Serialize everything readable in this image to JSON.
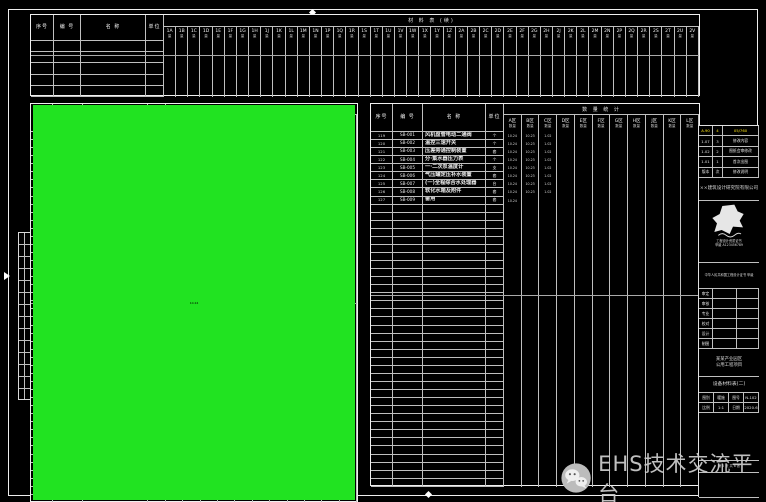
{
  "colors": {
    "green": "#21e321",
    "yellow": "#ffe712",
    "cyan": "#25e6f0",
    "white": "#eaeaea",
    "line": "#bfbfbf"
  },
  "watermark": {
    "text": "EHS技术交流平台",
    "icon": "wechat-icon"
  },
  "schedules": {
    "top": {
      "title": "材 料 表 (续)",
      "fixed": [
        "序号",
        "编 号",
        "名  称",
        "单位"
      ],
      "col_sub": "量",
      "cols": [
        "1A",
        "1B",
        "1C",
        "1D",
        "1E",
        "1F",
        "1G",
        "1H",
        "1J",
        "1K",
        "1L",
        "1M",
        "1N",
        "1P",
        "1Q",
        "1R",
        "1S",
        "1T",
        "1U",
        "1V",
        "1W",
        "1X",
        "1Y",
        "1Z",
        "2A",
        "2B",
        "2C",
        "2D",
        "2E",
        "2F",
        "2G",
        "2H",
        "2J",
        "2K",
        "2L",
        "2M",
        "2N",
        "2P",
        "2Q",
        "2R",
        "2S",
        "2T",
        "2U",
        "2V"
      ],
      "empty_rows": 5
    },
    "left": {
      "title": "数 量 统 计",
      "fixed": [
        "序号",
        "编 号",
        "名  称",
        "单位"
      ],
      "col_sub": "数量",
      "cols": [
        "A区",
        "B区",
        "C区",
        "D区",
        "E区",
        "F区",
        "G区",
        "H区",
        "J区",
        "K区",
        "L区"
      ],
      "rows": [
        {
          "n": "73",
          "id": "ZB-404",
          "nm": "离心式冷水机组",
          "sp": "台",
          "c": "g",
          "cc": "w",
          "v": [
            "10.24",
            "5.02"
          ],
          "hl": 2
        },
        {
          "n": "74",
          "id": "ZB-405",
          "nm": "卧式端吸离心泵",
          "sp": "台",
          "c": "g",
          "cc": "w",
          "v": [
            "10.24",
            "5.02"
          ],
          "hl": 2
        },
        {
          "n": "75",
          "id": "ZB-406",
          "nm": "板式换热器",
          "sp": "台",
          "c": "g",
          "cc": "w",
          "v": [
            "10.24",
            "5.02"
          ],
          "hl": 2
        },
        {
          "n": "76",
          "id": "ZB-407",
          "nm": "全自动软水装置",
          "sp": "套",
          "c": "g",
          "cc": "w",
          "v": [
            "10.24",
            "5.02",
            "1.02",
            "1.02"
          ],
          "hl": 4
        },
        {
          "n": "77",
          "id": "ZB-408",
          "nm": "(一) 落地式膨胀水箱",
          "sp": "套",
          "c": "w",
          "v": [
            "10.24",
            "5.02"
          ],
          "hl": -1
        },
        {
          "n": "78",
          "id": "ZB-409",
          "nm": "集水器·分水器",
          "sp": "套",
          "c": "g",
          "cc": "w",
          "v": [
            "10.24",
            "5.02"
          ],
          "hl": 2
        },
        {
          "n": "79",
          "id": "ZB-410",
          "nm": "定压补水排气装置",
          "sp": "套",
          "c": "g",
          "cc": "w",
          "v": [
            "10.24",
            "5.02"
          ],
          "hl": 2
        },
        {
          "n": "80",
          "id": "ZB-411",
          "nm": "电子水处理仪",
          "sp": "台",
          "c": "g",
          "v": [
            "10.24",
            "5.02"
          ],
          "hl": 2
        },
        {
          "n": "81",
          "id": "ZB-412",
          "nm": "闭式冷却塔",
          "sp": "台",
          "c": "g",
          "v": [
            "10.24",
            "5.02"
          ],
          "hl": 2
        },
        {
          "n": "82",
          "id": "ZB-413",
          "nm": "吊顶式新风换气机",
          "sp": "台",
          "c": "y",
          "v": [
            "10.24"
          ],
          "hl": 2
        },
        {
          "n": "83",
          "id": "ZB-414",
          "nm": "组合风柜",
          "sp": "台",
          "c": "w",
          "v": [
            "10.24"
          ],
          "hl": -1
        },
        {
          "n": "84",
          "id": "ZB-415",
          "nm": "柜式离心风机箱",
          "sp": "台",
          "c": "w",
          "v": [
            "10.24"
          ],
          "hl": -1
        },
        {
          "n": "85",
          "id": "ZB-416",
          "nm": "Φ-25不锈钢波纹管",
          "sp": "米",
          "c": "c",
          "v": [
            "10.24",
            "5.02",
            "1.02"
          ],
          "hl": 4
        },
        {
          "n": "86",
          "id": "ZB-417",
          "nm": "Y型过滤器",
          "sp": "个",
          "c": "w",
          "v": [
            "10.24"
          ],
          "hl": -1
        },
        {
          "n": "87",
          "id": "ZB-418",
          "nm": "(配对)法兰",
          "sp": "副",
          "c": "w",
          "v": [
            "10.24"
          ],
          "hl": -1
        },
        {
          "n": "88",
          "id": "ZB-419",
          "nm": "橡胶软接头",
          "sp": "个",
          "c": "w",
          "v": [
            "10.24"
          ],
          "hl": -1
        },
        {
          "n": "89",
          "id": "ZB-420",
          "nm": "(一) 多叶送风口",
          "sp": "个",
          "c": "y",
          "v": [
            "10.24"
          ],
          "hl": 2
        },
        {
          "n": "90",
          "id": "ZB-421",
          "nm": "(一)电动调节阀",
          "sp": "个",
          "c": "y",
          "v": [
            "10.24"
          ],
          "hl": 2
        },
        {
          "n": "91",
          "id": "ZB-422",
          "nm": "(一) 静态平衡阀",
          "sp": "个",
          "c": "c",
          "v": [
            "10.24"
          ],
          "hl": 2
        },
        {
          "n": "92",
          "id": "ZB-423",
          "nm": "(一)动态压差平衡阀",
          "sp": "个",
          "c": "c",
          "v": [
            "10.24"
          ],
          "hl": 2
        },
        {
          "n": "93",
          "id": "ZB-424",
          "nm": "(一) 自动排气阀",
          "sp": "个",
          "c": "g",
          "cc": "y",
          "v": [
            "10.24"
          ],
          "hl": 2
        },
        {
          "n": "94",
          "id": "ZB-425",
          "nm": "金属软管",
          "sp": "根",
          "c": "c",
          "v": [
            "10.24"
          ],
          "hl": 2
        },
        {
          "n": "95",
          "id": "ZB-426",
          "nm": "铝合金百叶回风口",
          "sp": "个",
          "c": "c",
          "v": [
            "10.24"
          ],
          "hl": 2
        },
        {
          "n": "96",
          "id": "ZB-427",
          "nm": "方形散流器",
          "sp": "个",
          "c": "c",
          "v": [
            "10.24"
          ],
          "hl": 2
        },
        {
          "n": "97",
          "id": "ZB-428",
          "nm": "球形旋流风口",
          "sp": "个",
          "c": "g",
          "v": [
            "10.24"
          ],
          "hl": 2
        },
        {
          "n": "98",
          "id": "ZB-429",
          "nm": "单层百叶风口",
          "sp": "个",
          "c": "g",
          "v": [
            "10.24"
          ],
          "hl": 2
        },
        {
          "n": "99",
          "id": "ZB-430",
          "nm": "双层百叶风口",
          "sp": "个",
          "c": "g",
          "v": [
            "10.24"
          ],
          "hl": 2
        },
        {
          "n": "100",
          "id": "ZB-431",
          "nm": "防雨百叶风口",
          "sp": "个",
          "c": "g",
          "v": [
            "10.24"
          ],
          "hl": 2
        },
        {
          "n": "101",
          "id": "ZB-432",
          "nm": "自垂式百叶风口",
          "sp": "个",
          "c": "y",
          "v": [
            "10.24"
          ],
          "hl": 2
        },
        {
          "n": "102",
          "id": "ZB-433",
          "nm": "白色PE",
          "sp": "米",
          "c": "c",
          "v": [
            "10.24"
          ],
          "hl": 2
        },
        {
          "n": "103",
          "id": "ZB-434",
          "nm": "·70℃防火阀",
          "sp": "个",
          "c": "g",
          "v": [
            "10.24"
          ],
          "hl": 2
        },
        {
          "n": "104",
          "id": "ZB-435",
          "nm": "·70℃自动防火阀",
          "sp": "个",
          "c": "g",
          "v": [
            "10.24"
          ],
          "hl": 2
        },
        {
          "n": "105",
          "id": "ZB-436",
          "nm": "·280℃排烟防火阀",
          "sp": "个",
          "c": "g",
          "v": [
            "10.24"
          ],
          "hl": 2
        },
        {
          "n": "106",
          "id": "ZB-437",
          "nm": "·电动排烟阀",
          "sp": "个",
          "c": "g",
          "v": [
            "10.24"
          ],
          "hl": 2
        },
        {
          "n": "107",
          "id": "ZB-438",
          "nm": "·280℃排烟口",
          "sp": "个",
          "c": "g",
          "v": [
            "10.24"
          ],
          "hl": 2
        },
        {
          "n": "108",
          "id": "ZB-439",
          "nm": "70℃板式防火调节阀",
          "sp": "个",
          "c": "g",
          "v": [
            "10.24"
          ],
          "hl": 2
        },
        {
          "n": "109",
          "id": "ZB-440",
          "nm": "(一) 消声静压箱",
          "sp": "个",
          "c": "c",
          "v": [
            "10.24"
          ],
          "hl": 2
        },
        {
          "n": "110",
          "id": "ZB-441",
          "nm": "·消声器",
          "sp": "个",
          "c": "g",
          "v": [
            "10.24"
          ],
          "hl": 2
        },
        {
          "n": "111",
          "id": "ZB-442",
          "nm": "(一)帆布软接",
          "sp": "米",
          "c": "g",
          "v": [
            "10.24"
          ],
          "hl": 2
        },
        {
          "n": "112",
          "id": "ZB-443",
          "nm": "镀锌钢板风管",
          "sp": "㎡",
          "c": "g",
          "v": [
            "10.24"
          ],
          "hl": 2
        },
        {
          "n": "113",
          "id": "ZB-444",
          "nm": "(铝箔)玻璃棉保温板",
          "sp": "㎡",
          "c": "g",
          "v": [
            "10.24"
          ],
          "hl": 2
        },
        {
          "n": "114",
          "id": "LB-445",
          "nm": "Φ108×4无缝钢管(-)",
          "sp": "米",
          "c": "w",
          "v": [
            "10.24",
            "1.02",
            "1.02"
          ],
          "hl": -1
        },
        {
          "n": "115",
          "id": "LB-446",
          "nm": "Φ89×4无缝钢管(-)",
          "sp": "米",
          "c": "w",
          "v": [
            "10.24",
            "1.02",
            "1.02"
          ],
          "hl": -1
        },
        {
          "n": "116",
          "id": "LB-447",
          "nm": "·Φ76×4焊接钢管",
          "sp": "米",
          "c": "w",
          "v": [
            "10.24",
            "1.02",
            "1.02"
          ],
          "hl": -1
        },
        {
          "n": "117",
          "id": "LB-448",
          "nm": "·Φ57×3.5焊接钢管",
          "sp": "米",
          "c": "w",
          "v": [
            "10.24",
            "1.02",
            "1.02"
          ],
          "hl": -1
        },
        {
          "n": "118",
          "id": "LB-449",
          "nm": "Φ48×3.5焊接钢管",
          "sp": "米",
          "c": "w",
          "v": [
            "10.24",
            "1.02",
            "1.02"
          ],
          "hl": -1
        }
      ],
      "empty_rows": 0
    },
    "right": {
      "title": "数 量 统 计",
      "fixed": [
        "序号",
        "编 号",
        "名  称",
        "单位"
      ],
      "col_sub": "数量",
      "cols": [
        "A区",
        "B区",
        "C区",
        "D区",
        "E区",
        "F区",
        "G区",
        "H区",
        "J区",
        "K区",
        "L区"
      ],
      "rows": [
        {
          "n": "119",
          "id": "SB-001",
          "nm": "风机盘管电动二通阀",
          "sp": "个",
          "c": "w",
          "v": [
            "10.24",
            "10.23",
            "1.02"
          ],
          "hl": -1
        },
        {
          "n": "120",
          "id": "SB-002",
          "nm": "温控三速开关",
          "sp": "个",
          "c": "w",
          "v": [
            "10.24",
            "10.23",
            "1.02"
          ],
          "hl": -1
        },
        {
          "n": "121",
          "id": "SB-003",
          "nm": "压差旁通控制装置",
          "sp": "套",
          "c": "w",
          "v": [
            "10.24",
            "10.23",
            "1.02"
          ],
          "hl": -1
        },
        {
          "n": "122",
          "id": "SB-004",
          "nm": "分·集水器压力表",
          "sp": "个",
          "c": "w",
          "v": [
            "10.24",
            "10.23",
            "1.02"
          ],
          "hl": -1
        },
        {
          "n": "123",
          "id": "SB-005",
          "nm": "一·二次泵温度计",
          "sp": "支",
          "c": "w",
          "v": [
            "10.24",
            "10.23",
            "1.02"
          ],
          "hl": -1
        },
        {
          "n": "124",
          "id": "SB-006",
          "nm": "气压罐定压补水装置",
          "sp": "套",
          "c": "w",
          "v": [
            "10.24",
            "10.23",
            "1.02"
          ],
          "hl": -1
        },
        {
          "n": "125",
          "id": "SB-007",
          "nm": "(一)全程综合水处理器",
          "sp": "台",
          "c": "w",
          "v": [
            "10.24",
            "10.23",
            "1.02"
          ],
          "hl": -1
        },
        {
          "n": "126",
          "id": "SB-008",
          "nm": "软化水箱及附件",
          "sp": "套",
          "c": "w",
          "v": [
            "10.24",
            "10.23",
            "1.02"
          ],
          "hl": -1
        },
        {
          "n": "127",
          "id": "SB-009",
          "nm": "备用",
          "sp": "套",
          "c": "w",
          "v": [
            "10.24"
          ],
          "hl": -1
        }
      ],
      "empty_rows": 35
    }
  },
  "titleblock": {
    "revisions": [
      {
        "a": "A.90",
        "b": "4",
        "c": "05/760",
        "hl": true
      },
      {
        "a": "1.07",
        "b": "3",
        "c": "修改内容",
        "hl": false
      },
      {
        "a": "1.02",
        "b": "2",
        "c": "图纸会审修改",
        "hl": false
      },
      {
        "a": "1.01",
        "b": "1",
        "c": "首次出图",
        "hl": false
      },
      {
        "a": "版本",
        "b": "次",
        "c": "修改说明",
        "hl": false
      }
    ],
    "company": "××建筑设计研究院有限公司",
    "stamp_lines": [
      "工程设计资质证书",
      "甲级 A123456789"
    ],
    "cert": "中华人民共和国工程设计证书 甲级",
    "signatures": [
      {
        "label": "审定",
        "value": ""
      },
      {
        "label": "审核",
        "value": ""
      },
      {
        "label": "专业",
        "value": ""
      },
      {
        "label": "校对",
        "value": ""
      },
      {
        "label": "设计",
        "value": ""
      },
      {
        "label": "制图",
        "value": ""
      }
    ],
    "project": [
      "某某产业园区",
      "公用工程项目"
    ],
    "drawing_title": "设备材料表(二)",
    "meta": [
      [
        {
          "k": "图别",
          "v": "暖施"
        },
        {
          "k": "图号",
          "v": "N-102"
        }
      ],
      [
        {
          "k": "比例",
          "v": "1:1"
        },
        {
          "k": "日期",
          "v": "2020.6"
        }
      ]
    ],
    "sheet": "第 2 张 共 8 张"
  }
}
